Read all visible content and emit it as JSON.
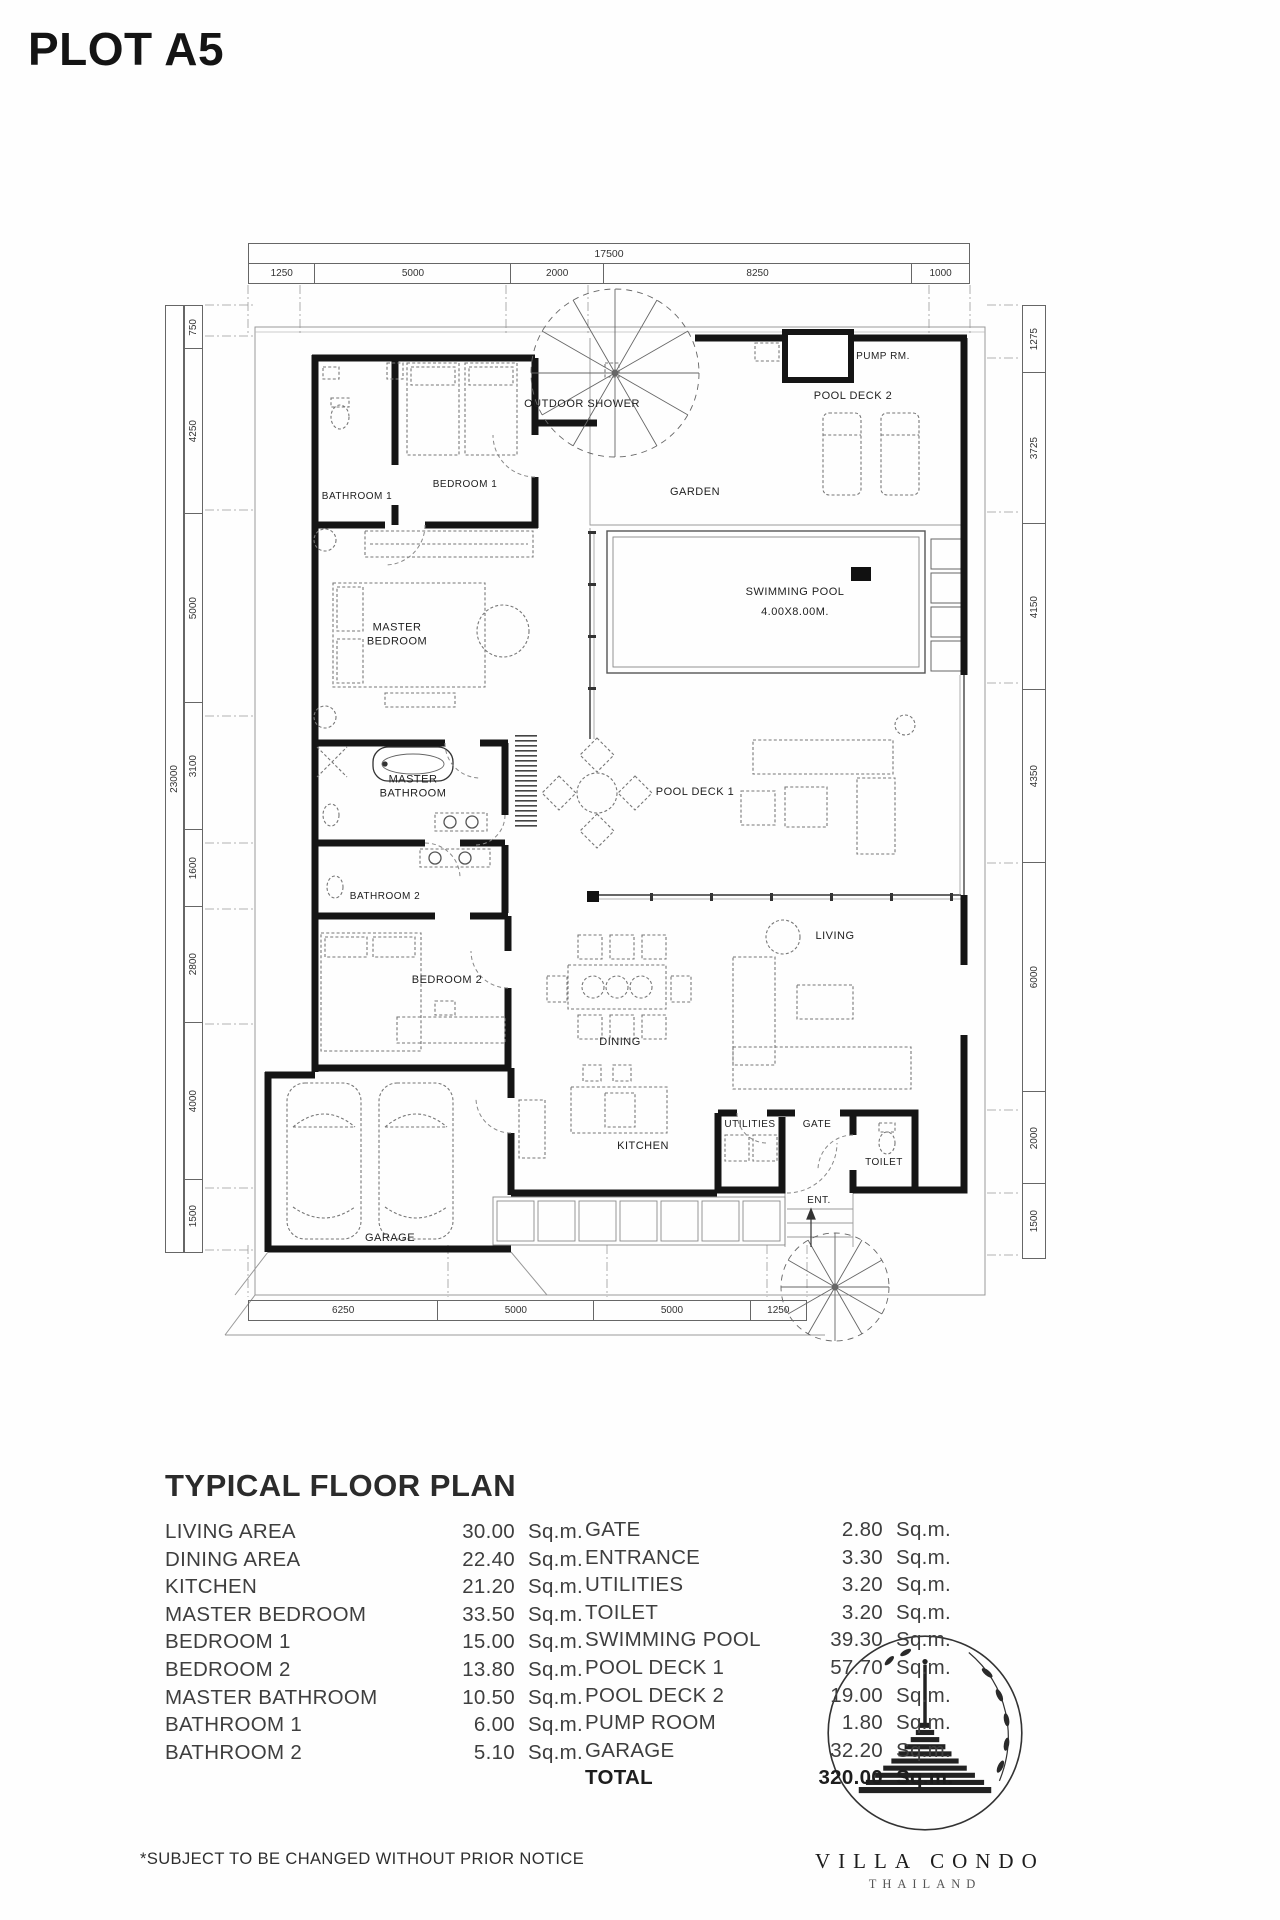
{
  "page": {
    "title": "PLOT A5"
  },
  "plan": {
    "dims": {
      "top_total": "17500",
      "top": [
        1250,
        5000,
        2000,
        8250,
        1000
      ],
      "left_total": "23000",
      "left": [
        750,
        4250,
        5000,
        3100,
        1600,
        2800,
        4000,
        1500
      ],
      "right": [
        1275,
        3725,
        4150,
        4350,
        6000,
        2000,
        1500
      ],
      "bottom": [
        6250,
        5000,
        5000,
        1250
      ]
    },
    "labels": {
      "bathroom1": "BATHROOM 1",
      "bedroom1": "BEDROOM 1",
      "outdoor_shower": "OUTDOOR SHOWER",
      "garden": "GARDEN",
      "pump": "PUMP RM.",
      "pool_deck2": "POOL DECK 2",
      "swimming_pool": "SWIMMING POOL",
      "pool_size": "4.00X8.00M.",
      "master_bedroom": "MASTER BEDROOM",
      "master_bathroom": "MASTER BATHROOM",
      "pool_deck1": "POOL DECK 1",
      "bathroom2": "BATHROOM 2",
      "bedroom2": "BEDROOM 2",
      "living": "LIVING",
      "dining": "DINING",
      "kitchen": "KITCHEN",
      "utilities": "UTILITIES",
      "gate": "GATE",
      "toilet": "TOILET",
      "garage": "GARAGE",
      "ent": "ENT."
    }
  },
  "summary": {
    "heading": "TYPICAL FLOOR PLAN",
    "unit": "Sq.m.",
    "left_rows": [
      {
        "label": "LIVING AREA",
        "value": "30.00"
      },
      {
        "label": "DINING AREA",
        "value": "22.40"
      },
      {
        "label": "KITCHEN",
        "value": "21.20"
      },
      {
        "label": "MASTER BEDROOM",
        "value": "33.50"
      },
      {
        "label": "BEDROOM 1",
        "value": "15.00"
      },
      {
        "label": "BEDROOM 2",
        "value": "13.80"
      },
      {
        "label": "MASTER BATHROOM",
        "value": "10.50"
      },
      {
        "label": "BATHROOM 1",
        "value": "6.00"
      },
      {
        "label": "BATHROOM 2",
        "value": "5.10"
      }
    ],
    "right_rows": [
      {
        "label": "GATE",
        "value": "2.80"
      },
      {
        "label": "ENTRANCE",
        "value": "3.30"
      },
      {
        "label": "UTILITIES",
        "value": "3.20"
      },
      {
        "label": "TOILET",
        "value": "3.20"
      },
      {
        "label": "SWIMMING POOL",
        "value": "39.30"
      },
      {
        "label": "POOL DECK 1",
        "value": "57.70"
      },
      {
        "label": "POOL DECK 2",
        "value": "19.00"
      },
      {
        "label": "PUMP ROOM",
        "value": "1.80"
      },
      {
        "label": "GARAGE",
        "value": "32.20"
      },
      {
        "label": "TOTAL",
        "value": "320.00",
        "bold": true
      }
    ],
    "footnote": "*SUBJECT TO BE CHANGED WITHOUT PRIOR NOTICE"
  },
  "logo": {
    "brand": "VILLA CONDO",
    "country": "THAILAND"
  }
}
